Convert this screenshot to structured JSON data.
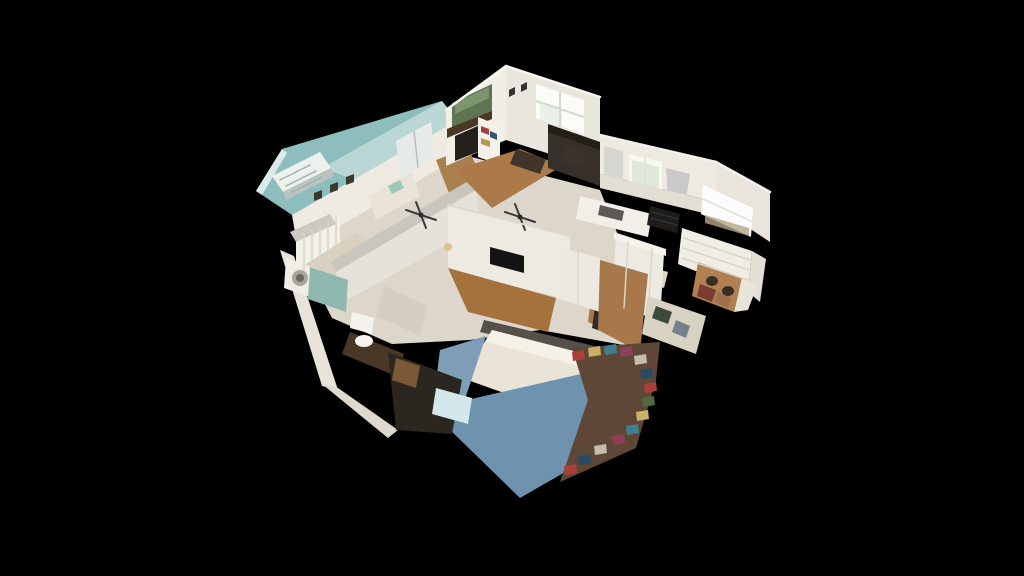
{
  "app": {
    "view": "3d-dollhouse-home-model",
    "background": "#000000"
  },
  "palette": {
    "background": "#000000",
    "cut_ceiling_teal": "#8ebdbd",
    "wall_white": "#efebe2",
    "wall_shadow": "#d9d5cb",
    "wood_floor": "#a9784a",
    "window_glow": "#fbfbf8",
    "sofa_dark": "#37302a",
    "appliance_black": "#1f1d1b",
    "bedroom_rug_blue": "#6f93ae",
    "mattress_white": "#eae4d6",
    "shower_curtain_teal": "#8fb8b0"
  },
  "scene": {
    "viewbox": "0 0 1024 576",
    "polygons": [
      {
        "name": "teal-ceiling-plane",
        "fill": "#8ebdbd",
        "points": "256,191 282,149 442,101 458,121 352,197 292,215"
      },
      {
        "name": "teal-ceiling-highlight",
        "fill": "#c3dcd9",
        "opacity": 0.85,
        "points": "322,168 442,101 458,121 372,186"
      },
      {
        "name": "teal-ceiling-edge",
        "fill": "#dcebe9",
        "points": "256,191 282,149 287,153 262,195"
      },
      {
        "name": "interior-base",
        "fill": "#ddd7cb",
        "points": "296,248 460,154 600,190 640,290 640,348 540,330 470,340 392,344 332,318"
      },
      {
        "name": "stair-rail",
        "fill": "#eef0ec",
        "points": "272,176 320,152 331,168 283,192"
      },
      {
        "name": "stair-rail-shadow",
        "fill": "#b9c4c2",
        "points": "283,192 331,168 334,176 286,200"
      },
      {
        "name": "nursery-back-wall",
        "fill": "#efebe2",
        "points": "292,215 456,121 461,156 298,250"
      },
      {
        "name": "french-doors",
        "fill": "#e6ebe8",
        "points": "396,141 431,122 435,158 400,177"
      },
      {
        "name": "nursery-frame-1",
        "fill": "#3c3830",
        "points": "314,193 322,190 322,198 314,201"
      },
      {
        "name": "nursery-frame-2",
        "fill": "#3c3830",
        "points": "330,185 338,182 338,190 330,193"
      },
      {
        "name": "nursery-frame-3",
        "fill": "#3c3830",
        "points": "346,177 354,174 354,182 346,185"
      },
      {
        "name": "crib",
        "fill": "#f3f0e8",
        "points": "296,238 340,214 340,252 296,276"
      },
      {
        "name": "changing-dresser",
        "fill": "#eae4d8",
        "points": "368,196 412,172 420,196 376,220"
      },
      {
        "name": "dresser-decor",
        "fill": "#9fc6bb",
        "points": "388,186 400,180 404,188 392,194"
      },
      {
        "name": "nursery-floor",
        "fill": "#d9d0c0",
        "points": "300,268 356,232 398,260 342,300"
      },
      {
        "name": "upper-hall-floor",
        "fill": "#a9804e",
        "points": "436,160 468,148 482,178 450,196"
      },
      {
        "name": "hall-wall-top",
        "fill": "#c9c6be",
        "points": "330,262 470,180 476,190 336,272"
      },
      {
        "name": "hall-wall-face",
        "fill": "#e6e2d9",
        "points": "336,272 476,190 480,226 340,304"
      },
      {
        "name": "livingroom-left-wall",
        "fill": "#f1eee6",
        "points": "446,110 506,66 506,140 446,166"
      },
      {
        "name": "livingroom-right-wall",
        "fill": "#e9e6de",
        "points": "506,66 600,97 600,170 506,140"
      },
      {
        "name": "mantel-painting",
        "fill": "#5d7553",
        "points": "452,103 492,84 492,116 452,133"
      },
      {
        "name": "painting-sky",
        "fill": "#8aa27c",
        "opacity": 0.7,
        "points": "455,103 489,87 489,98 455,114"
      },
      {
        "name": "mantel",
        "fill": "#4a3726",
        "points": "447,129 492,111 492,119 447,138"
      },
      {
        "name": "fireplace",
        "fill": "#24201c",
        "points": "455,136 480,125 480,151 455,161"
      },
      {
        "name": "wall-frame-1",
        "fill": "#323230",
        "points": "509,90 515,87 515,94 509,97"
      },
      {
        "name": "wall-frame-2",
        "fill": "#323230",
        "points": "521,85 527,82 527,89 521,92"
      },
      {
        "name": "livingroom-window",
        "fill": "#fbfbf8",
        "points": "536,84 584,100 584,134 536,118"
      },
      {
        "name": "window-foliage-tint",
        "fill": "#dfe8da",
        "opacity": 0.55,
        "points": "540,101 562,108 562,126 540,119"
      },
      {
        "name": "bookshelf",
        "fill": "#f4f1ea",
        "points": "478,117 500,126 500,165 478,157"
      },
      {
        "name": "books-red",
        "fill": "#a34038",
        "points": "481,126 489,129 489,135 481,132"
      },
      {
        "name": "books-blue",
        "fill": "#31566e",
        "points": "490,131 497,134 497,140 490,137"
      },
      {
        "name": "books-yellow",
        "fill": "#b59a4e",
        "points": "481,138 490,141 490,147 481,144"
      },
      {
        "name": "livingroom-floor",
        "fill": "#ab7a48",
        "points": "455,170 520,149 562,166 492,208"
      },
      {
        "name": "dining-table",
        "fill": "#41342a",
        "points": "516,149 546,159 540,174 510,164"
      },
      {
        "name": "sofa-back",
        "fill": "#231e19",
        "points": "548,124 606,144 606,154 548,134"
      },
      {
        "name": "sofa",
        "fill": "#37302a",
        "points": "548,132 606,152 606,188 548,168"
      },
      {
        "name": "desk-chair",
        "fill": "#3a342c",
        "points": "566,146 586,152 582,167 562,161"
      },
      {
        "name": "kitchen-back-wall",
        "fill": "#eeeae2",
        "points": "600,135 716,162 716,202 600,174"
      },
      {
        "name": "glass-cabinet",
        "fill": "#d6d6d0",
        "points": "604,146 623,151 623,188 604,183"
      },
      {
        "name": "kitchen-window-1",
        "fill": "#f6f8f2",
        "points": "629,154 662,162 662,195 629,187"
      },
      {
        "name": "kitchen-window-1-tint",
        "fill": "#cfe0c8",
        "opacity": 0.6,
        "points": "632,160 659,167 659,190 632,183"
      },
      {
        "name": "range-hood",
        "fill": "#c9c9c7",
        "points": "666,168 690,174 686,199 668,196"
      },
      {
        "name": "backsplash",
        "fill": "#e2ded4",
        "points": "600,174 716,202 716,216 600,188"
      },
      {
        "name": "island-counter",
        "fill": "#f2efe8",
        "points": "580,196 652,214 648,237 576,219"
      },
      {
        "name": "island-sink",
        "fill": "#5b5a56",
        "points": "600,205 624,211 622,221 598,215"
      },
      {
        "name": "range-stove",
        "fill": "#1f1d1b",
        "points": "650,206 680,214 677,233 647,225"
      },
      {
        "name": "window-wall-right",
        "fill": "#e9e5dc",
        "points": "716,162 770,192 770,242 716,206"
      },
      {
        "name": "kitchen-window-2",
        "fill": "#fcfcfa",
        "points": "703,185 753,208 751,237 701,214"
      },
      {
        "name": "window-2-horizon",
        "fill": "#b0a587",
        "opacity": 0.8,
        "points": "705,215 749,228 749,236 705,223"
      },
      {
        "name": "lower-cabinets",
        "fill": "#f0ede5",
        "points": "682,228 752,251 748,292 678,264"
      },
      {
        "name": "cabinet-end-panel",
        "fill": "#e3dfd6",
        "points": "752,251 766,259 760,302 748,292"
      },
      {
        "name": "kitchen-floor",
        "fill": "#dcd6c8",
        "points": "578,248 668,272 664,288 574,264"
      },
      {
        "name": "hall-closet-doors",
        "fill": "#edeae3",
        "points": "616,236 664,253 660,322 612,302"
      },
      {
        "name": "closet-door-trim",
        "fill": "#f5f2ec",
        "points": "614,232 666,249 666,256 614,239"
      },
      {
        "name": "right-hall-wood-floor",
        "fill": "#a87647",
        "points": "592,290 616,298 612,332 588,322"
      },
      {
        "name": "dark-desk",
        "fill": "#2e2a26",
        "points": "596,300 638,316 632,342 592,328"
      },
      {
        "name": "breakfast-nook-floor",
        "fill": "#b08050",
        "points": "698,262 742,278 734,312 692,296"
      },
      {
        "name": "nook-clutter-1",
        "fill": "#7a3b30",
        "points": "700,284 716,290 712,302 697,296"
      },
      {
        "name": "nook-clutter-2",
        "fill": "#a0704a",
        "points": "718,292 732,298 728,308 714,302"
      },
      {
        "name": "nook-end-wall",
        "fill": "#e8e4da",
        "points": "742,278 757,286 748,310 734,312"
      },
      {
        "name": "bedroom-tv-wall",
        "fill": "#edeae2",
        "points": "448,205 570,236 570,300 448,270"
      },
      {
        "name": "wall-tv",
        "fill": "#141414",
        "points": "490,247 524,256 524,273 490,264"
      },
      {
        "name": "bedroom-closet-doors",
        "fill": "#ece9e2",
        "points": "556,246 600,258 600,312 556,298"
      },
      {
        "name": "bedroom-wood-floor-a",
        "fill": "#a5713d",
        "points": "448,268 556,298 548,332 468,312"
      },
      {
        "name": "bedroom-wood-floor-b",
        "fill": "#a9784a",
        "points": "600,260 648,274 640,352 598,330"
      },
      {
        "name": "family-nook",
        "fill": "#d7d2c2",
        "points": "648,296 706,316 696,354 642,334"
      },
      {
        "name": "family-nook-item-1",
        "fill": "#3e4a3a",
        "points": "656,306 672,312 668,324 652,318"
      },
      {
        "name": "family-nook-item-2",
        "fill": "#72808c",
        "points": "676,320 690,326 686,338 672,332"
      },
      {
        "name": "headboard",
        "fill": "#55504a",
        "points": "484,320 620,352 616,364 480,332"
      },
      {
        "name": "bed-mattress",
        "fill": "#eae4d6",
        "points": "492,330 616,362 552,410 462,378"
      },
      {
        "name": "bed-pillows",
        "fill": "#f5f1e7",
        "points": "492,330 616,362 610,374 486,342"
      },
      {
        "name": "blue-rug-left",
        "fill": "#7e9db6",
        "points": "440,350 486,336 462,408 434,396"
      },
      {
        "name": "blue-rug-bottom",
        "fill": "#6f93ae",
        "points": "458,402 616,366 638,430 520,498 446,426"
      },
      {
        "name": "clutter-base",
        "fill": "#5e4736",
        "points": "572,348 660,342 656,380 636,448 560,482 588,400"
      },
      {
        "name": "clutter-chip",
        "fill": "#a84038",
        "points": "572,352 584,350 585,359 573,361"
      },
      {
        "name": "clutter-chip",
        "fill": "#c9b169",
        "points": "588,348 600,346 601,355 589,357"
      },
      {
        "name": "clutter-chip",
        "fill": "#3f7f8e",
        "points": "604,346 616,344 617,353 605,355"
      },
      {
        "name": "clutter-chip",
        "fill": "#8e4058",
        "points": "620,348 632,346 633,355 621,357"
      },
      {
        "name": "clutter-chip",
        "fill": "#c5bdb0",
        "points": "634,356 646,354 647,363 635,365"
      },
      {
        "name": "clutter-chip",
        "fill": "#294a63",
        "points": "640,370 652,368 653,377 641,379"
      },
      {
        "name": "clutter-chip",
        "fill": "#a84038",
        "points": "644,384 656,382 657,391 645,393"
      },
      {
        "name": "clutter-chip",
        "fill": "#4d6c3d",
        "points": "642,398 654,396 655,405 643,407"
      },
      {
        "name": "clutter-chip",
        "fill": "#c9b169",
        "points": "636,412 648,410 649,419 637,421"
      },
      {
        "name": "clutter-chip",
        "fill": "#3f7f8e",
        "points": "626,426 638,424 639,433 627,435"
      },
      {
        "name": "clutter-chip",
        "fill": "#8e4058",
        "points": "612,436 624,434 625,443 613,445"
      },
      {
        "name": "clutter-chip",
        "fill": "#c5bdb0",
        "points": "594,446 606,444 607,453 595,455"
      },
      {
        "name": "clutter-chip",
        "fill": "#294a63",
        "points": "578,456 590,454 591,463 579,465"
      },
      {
        "name": "clutter-chip",
        "fill": "#a84038",
        "points": "564,466 576,464 577,473 565,475"
      },
      {
        "name": "outer-wall-southwest",
        "fill": "#e8e4da",
        "points": "280,250 294,256 338,390 322,386"
      },
      {
        "name": "outer-wall-southwest-2",
        "fill": "#ded9ce",
        "points": "322,384 338,388 398,430 388,438"
      },
      {
        "name": "laundry-wall",
        "fill": "#ccc9c1",
        "points": "290,232 330,214 336,224 296,242"
      },
      {
        "name": "washer",
        "fill": "#f0ede6",
        "points": "286,258 320,270 318,300 284,288"
      },
      {
        "name": "shower-curtain",
        "fill": "#8fb8b0",
        "points": "310,267 348,280 346,312 308,299"
      },
      {
        "name": "toilet-tank",
        "fill": "#f4f2ec",
        "points": "352,312 374,318 372,334 350,328"
      },
      {
        "name": "bath-dresser",
        "fill": "#4a3726",
        "points": "350,332 404,354 396,376 342,354"
      },
      {
        "name": "bath-hall-floor",
        "fill": "#d4cfc0",
        "points": "384,286 428,306 420,336 376,316"
      },
      {
        "name": "office-dark-area",
        "fill": "#2b2620",
        "points": "388,352 462,380 452,434 396,430"
      },
      {
        "name": "office-wood-item",
        "fill": "#7a5a36",
        "points": "396,358 420,366 416,388 392,380"
      },
      {
        "name": "office-glow-screen",
        "fill": "#d3e7ec",
        "points": "436,388 472,398 468,424 432,414"
      }
    ],
    "lines": [
      {
        "name": "crib-slat",
        "x1": 304,
        "y1": 234,
        "x2": 304,
        "y2": 270,
        "stroke": "#d8d4ca",
        "w": 1.5
      },
      {
        "name": "crib-slat",
        "x1": 312,
        "y1": 230,
        "x2": 312,
        "y2": 266,
        "stroke": "#d8d4ca",
        "w": 1.5
      },
      {
        "name": "crib-slat",
        "x1": 320,
        "y1": 226,
        "x2": 320,
        "y2": 262,
        "stroke": "#d8d4ca",
        "w": 1.5
      },
      {
        "name": "crib-slat",
        "x1": 328,
        "y1": 221,
        "x2": 328,
        "y2": 258,
        "stroke": "#d8d4ca",
        "w": 1.5
      },
      {
        "name": "crib-slat",
        "x1": 336,
        "y1": 217,
        "x2": 336,
        "y2": 253,
        "stroke": "#d8d4ca",
        "w": 1.5
      },
      {
        "name": "stair-slat",
        "x1": 280,
        "y1": 180,
        "x2": 310,
        "y2": 165,
        "stroke": "#9fb4b2",
        "w": 1.5
      },
      {
        "name": "stair-slat",
        "x1": 286,
        "y1": 186,
        "x2": 316,
        "y2": 171,
        "stroke": "#9fb4b2",
        "w": 1.5
      },
      {
        "name": "stair-slat",
        "x1": 292,
        "y1": 192,
        "x2": 322,
        "y2": 177,
        "stroke": "#9fb4b2",
        "w": 1.5
      },
      {
        "name": "french-door-mullion",
        "x1": 414,
        "y1": 131,
        "x2": 418,
        "y2": 167,
        "stroke": "#b8bdb9",
        "w": 1.5
      },
      {
        "name": "window-mullion",
        "x1": 560,
        "y1": 92,
        "x2": 560,
        "y2": 126,
        "stroke": "#d9d9d2",
        "w": 2
      },
      {
        "name": "window-mullion",
        "x1": 536,
        "y1": 101,
        "x2": 584,
        "y2": 117,
        "stroke": "#d9d9d2",
        "w": 2
      },
      {
        "name": "kitchen-window-frame",
        "x1": 645,
        "y1": 158,
        "x2": 645,
        "y2": 191,
        "stroke": "#dddfd8",
        "w": 1.5
      },
      {
        "name": "kitchen-window-2-mullion",
        "x1": 703,
        "y1": 199,
        "x2": 753,
        "y2": 222,
        "stroke": "#e4e4e0",
        "w": 2
      },
      {
        "name": "closet-panel-line",
        "x1": 628,
        "y1": 242,
        "x2": 624,
        "y2": 308,
        "stroke": "#d9d6cd",
        "w": 1.5
      },
      {
        "name": "closet-panel-line",
        "x1": 652,
        "y1": 249,
        "x2": 648,
        "y2": 315,
        "stroke": "#d9d6cd",
        "w": 1.5
      },
      {
        "name": "closet-panel-line",
        "x1": 578,
        "y1": 252,
        "x2": 578,
        "y2": 305,
        "stroke": "#dbd8d0",
        "w": 1.5
      },
      {
        "name": "drawer-line",
        "x1": 684,
        "y1": 238,
        "x2": 750,
        "y2": 260,
        "stroke": "#d8d5cb",
        "w": 1.5
      },
      {
        "name": "drawer-line",
        "x1": 683,
        "y1": 248,
        "x2": 749,
        "y2": 270,
        "stroke": "#d8d5cb",
        "w": 1.5
      },
      {
        "name": "drawer-line",
        "x1": 682,
        "y1": 258,
        "x2": 748,
        "y2": 280,
        "stroke": "#d8d5cb",
        "w": 1.5
      },
      {
        "name": "stove-grate",
        "x1": 652,
        "y1": 212,
        "x2": 678,
        "y2": 219,
        "stroke": "#3a3836",
        "w": 1
      },
      {
        "name": "stove-grate",
        "x1": 651,
        "y1": 218,
        "x2": 677,
        "y2": 225,
        "stroke": "#3a3836",
        "w": 1
      },
      {
        "name": "ceiling-fan-blade",
        "x1": 406,
        "y1": 210,
        "x2": 436,
        "y2": 220,
        "stroke": "#3a3a3a",
        "w": 2
      },
      {
        "name": "ceiling-fan-blade",
        "x1": 416,
        "y1": 202,
        "x2": 426,
        "y2": 228,
        "stroke": "#3a3a3a",
        "w": 2
      },
      {
        "name": "ceiling-fan-blade",
        "x1": 505,
        "y1": 212,
        "x2": 535,
        "y2": 222,
        "stroke": "#3a3a3a",
        "w": 2
      },
      {
        "name": "ceiling-fan-blade",
        "x1": 515,
        "y1": 204,
        "x2": 525,
        "y2": 230,
        "stroke": "#3a3a3a",
        "w": 2
      },
      {
        "name": "wall-top-highlight",
        "x1": 446,
        "y1": 110,
        "x2": 506,
        "y2": 66,
        "stroke": "#f8f6f0",
        "w": 2.5
      },
      {
        "name": "wall-top-highlight",
        "x1": 506,
        "y1": 66,
        "x2": 600,
        "y2": 97,
        "stroke": "#f8f6f0",
        "w": 2.5
      },
      {
        "name": "wall-top-highlight",
        "x1": 600,
        "y1": 135,
        "x2": 716,
        "y2": 162,
        "stroke": "#f4f1ea",
        "w": 2.5
      },
      {
        "name": "wall-top-highlight",
        "x1": 716,
        "y1": 162,
        "x2": 770,
        "y2": 192,
        "stroke": "#f4f1ea",
        "w": 2.5
      },
      {
        "name": "wall-top-highlight",
        "x1": 448,
        "y1": 205,
        "x2": 570,
        "y2": 236,
        "stroke": "#dcd9d1",
        "w": 2
      }
    ],
    "ellipses": [
      {
        "name": "washer-door",
        "cx": 300,
        "cy": 278,
        "rx": 8,
        "ry": 8,
        "fill": "#a8a5a0"
      },
      {
        "name": "washer-door-glass",
        "cx": 300,
        "cy": 278,
        "rx": 4,
        "ry": 4,
        "fill": "#6b6862"
      },
      {
        "name": "toilet-bowl",
        "cx": 364,
        "cy": 341,
        "rx": 9,
        "ry": 6,
        "fill": "#f6f4ee"
      },
      {
        "name": "chandelier",
        "cx": 448,
        "cy": 247,
        "rx": 4,
        "ry": 4,
        "fill": "#d9c48c"
      },
      {
        "name": "nook-chair",
        "cx": 712,
        "cy": 281,
        "rx": 6,
        "ry": 5,
        "fill": "#3a2e24"
      },
      {
        "name": "nook-chair",
        "cx": 728,
        "cy": 291,
        "rx": 6,
        "ry": 5,
        "fill": "#3a2e24"
      },
      {
        "name": "ceiling-fan-hub",
        "cx": 421,
        "cy": 215,
        "rx": 2.5,
        "ry": 2.5,
        "fill": "#2c2c2c"
      },
      {
        "name": "ceiling-fan-hub",
        "cx": 520,
        "cy": 217,
        "rx": 2.5,
        "ry": 2.5,
        "fill": "#2c2c2c"
      }
    ]
  }
}
